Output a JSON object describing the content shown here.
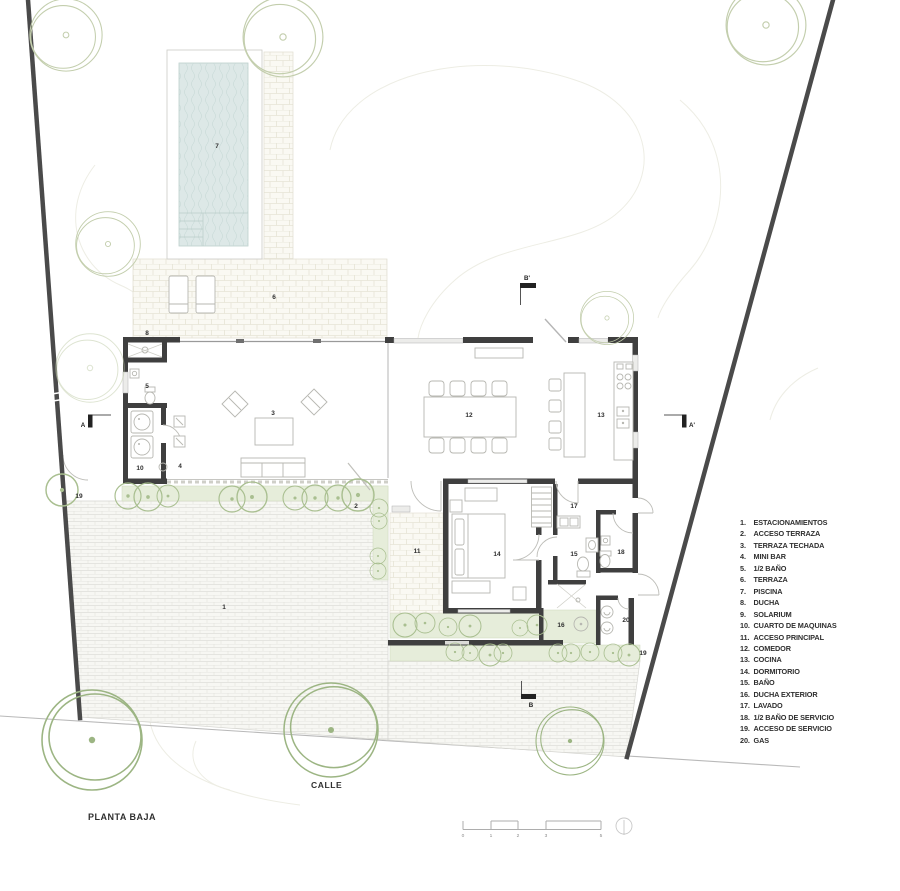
{
  "page": {
    "title": "PLANTA BAJA",
    "street": "CALLE"
  },
  "sections": {
    "a": "A",
    "a_prime": "A'",
    "b": "B",
    "b_prime": "B'"
  },
  "scale": {
    "ticks": [
      "0",
      "1",
      "2",
      "3",
      "5"
    ]
  },
  "legend": [
    {
      "num": "1.",
      "label": "ESTACIONAMIENTOS"
    },
    {
      "num": "2.",
      "label": "ACCESO TERRAZA"
    },
    {
      "num": "3.",
      "label": "TERRAZA TECHADA"
    },
    {
      "num": "4.",
      "label": "MINI BAR"
    },
    {
      "num": "5.",
      "label": "1/2 BAÑO"
    },
    {
      "num": "6.",
      "label": "TERRAZA"
    },
    {
      "num": "7.",
      "label": "PISCINA"
    },
    {
      "num": "8.",
      "label": "DUCHA"
    },
    {
      "num": "9.",
      "label": "SOLARIUM"
    },
    {
      "num": "10.",
      "label": "CUARTO DE MAQUINAS"
    },
    {
      "num": "11.",
      "label": "ACCESO PRINCIPAL"
    },
    {
      "num": "12.",
      "label": "COMEDOR"
    },
    {
      "num": "13.",
      "label": "COCINA"
    },
    {
      "num": "14.",
      "label": "DORMITORIO"
    },
    {
      "num": "15.",
      "label": "BAÑO"
    },
    {
      "num": "16.",
      "label": "DUCHA EXTERIOR"
    },
    {
      "num": "17.",
      "label": "LAVADO"
    },
    {
      "num": "18.",
      "label": "1/2 BAÑO DE SERVICIO"
    },
    {
      "num": "19.",
      "label": "ACCESO DE SERVICIO"
    },
    {
      "num": "20.",
      "label": "GAS"
    }
  ],
  "rooms": {
    "r1": "1",
    "r2": "2",
    "r3": "3",
    "r4": "4",
    "r5": "5",
    "r6": "6",
    "r7": "7",
    "r8": "8",
    "r10": "10",
    "r11": "11",
    "r12": "12",
    "r13": "13",
    "r14": "14",
    "r15": "15",
    "r16": "16",
    "r17": "17",
    "r18": "18",
    "r19": "19",
    "r19b": "19",
    "r20": "20"
  },
  "colors": {
    "wall": "#3f3f3f",
    "boundary": "#4a4a4a",
    "water": "#dde8e7",
    "green": "#e6edda",
    "tree": "#9cb583",
    "text": "#2f2f2f"
  }
}
